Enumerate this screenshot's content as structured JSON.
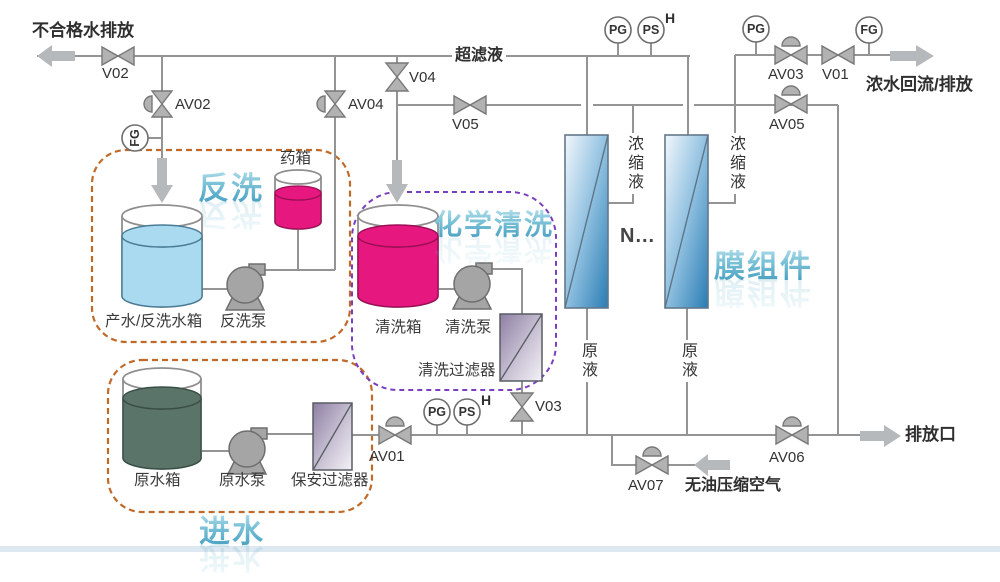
{
  "diagram": {
    "flows": {
      "unqualified_water": "不合格水排放",
      "ultrafiltrate": "超滤液",
      "concentrate_return": "浓水回流/排放",
      "drain_outlet": "排放口",
      "compressed_air": "无油压缩空气"
    },
    "sections": {
      "backwash": "反洗",
      "chemical_cleaning": "化学清洗",
      "inlet": "进水",
      "membrane_modules": "膜组件"
    },
    "equipment": {
      "med_tank": "药箱",
      "product_backwash_tank": "产水/反洗水箱",
      "backwash_pump": "反洗泵",
      "cleaning_tank": "清洗箱",
      "cleaning_pump": "清洗泵",
      "cleaning_filter": "清洗过滤器",
      "raw_water_tank": "原水箱",
      "raw_water_pump": "原水泵",
      "security_filter": "保安过滤器",
      "membrane_more": "N..."
    },
    "streams": {
      "concentrate": "浓缩液",
      "feed": "原液"
    },
    "valves": {
      "v01": "V01",
      "v02": "V02",
      "v03": "V03",
      "v04": "V04",
      "v05": "V05",
      "av01": "AV01",
      "av02": "AV02",
      "av03": "AV03",
      "av04": "AV04",
      "av05": "AV05",
      "av06": "AV06",
      "av07": "AV07"
    },
    "gauges": {
      "pressure": "PG",
      "pressure_switch": "PS",
      "flow": "FG",
      "high": "H"
    },
    "colors": {
      "pipe": "#949494",
      "valve_fill": "#b2b2b2",
      "arrow_fill": "#b5b9bc",
      "liquid_blue": "#a9daf0",
      "liquid_magenta": "#e6187f",
      "liquid_green": "#5a746a",
      "membrane_blue": "#2a7cb4",
      "filter_purple": "#8d7fa3",
      "box_orange": "#c06a2a",
      "box_purple": "#7a3fc0",
      "title_blue": "#3d98bc"
    }
  }
}
